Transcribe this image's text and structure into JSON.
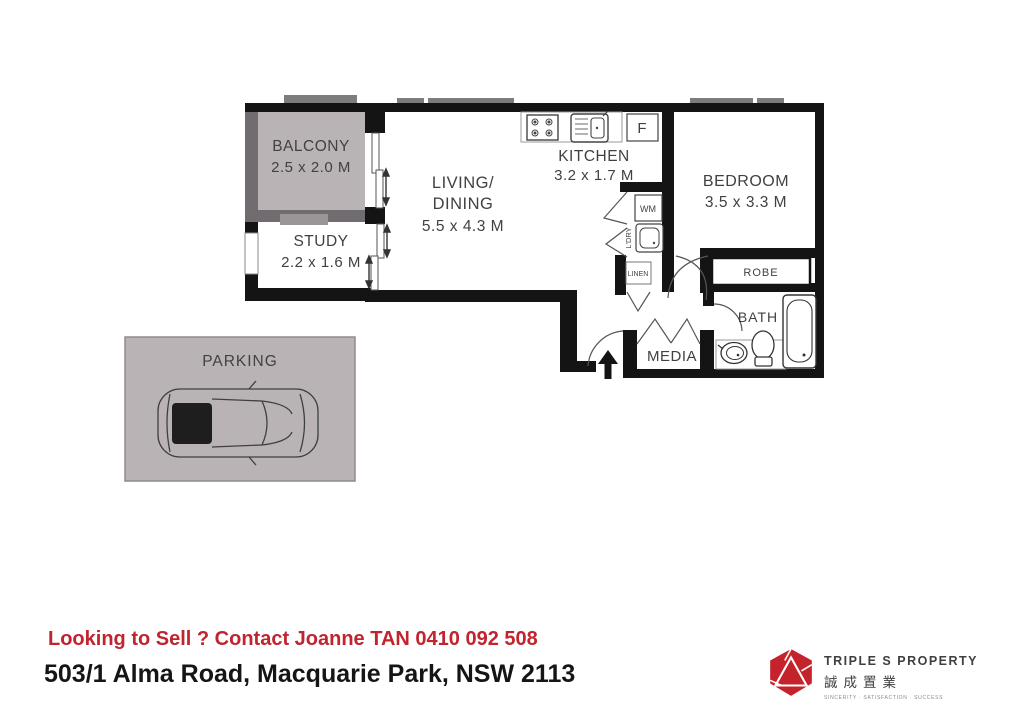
{
  "plan": {
    "rooms": {
      "balcony": {
        "label": "BALCONY",
        "dims": "2.5 x 2.0 M"
      },
      "study": {
        "label": "STUDY",
        "dims": "2.2 x 1.6 M"
      },
      "living": {
        "label1": "LIVING/",
        "label2": "DINING",
        "dims": "5.5 x 4.3 M"
      },
      "kitchen": {
        "label": "KITCHEN",
        "dims": "3.2 x 1.7 M"
      },
      "bedroom": {
        "label": "BEDROOM",
        "dims": "3.5 x 3.3 M"
      },
      "robe": {
        "label": "ROBE"
      },
      "bath": {
        "label": "BATH"
      },
      "media": {
        "label": "MEDIA"
      },
      "linen": {
        "label": "LINEN"
      },
      "laundry": {
        "label": "L'DRY",
        "wm": "WM"
      },
      "fridge": {
        "label": "F"
      },
      "parking": {
        "label": "PARKING"
      }
    },
    "colors": {
      "wall": "#141414",
      "window_gray": "#7d7d7d",
      "balcony_fill": "#bab3b6",
      "outer_wall_gray": "#716c70",
      "label_text": "#414141"
    }
  },
  "footer": {
    "promo": "Looking to Sell ? Contact Joanne TAN 0410 092 508",
    "address": "503/1 Alma Road, Macquarie Park, NSW 2113"
  },
  "logo": {
    "name": "TRIPLE S PROPERTY",
    "chinese": "誠成置業",
    "tagline": "SINCERITY · SATISFACTION · SUCCESS",
    "brand_red": "#c4232b"
  }
}
